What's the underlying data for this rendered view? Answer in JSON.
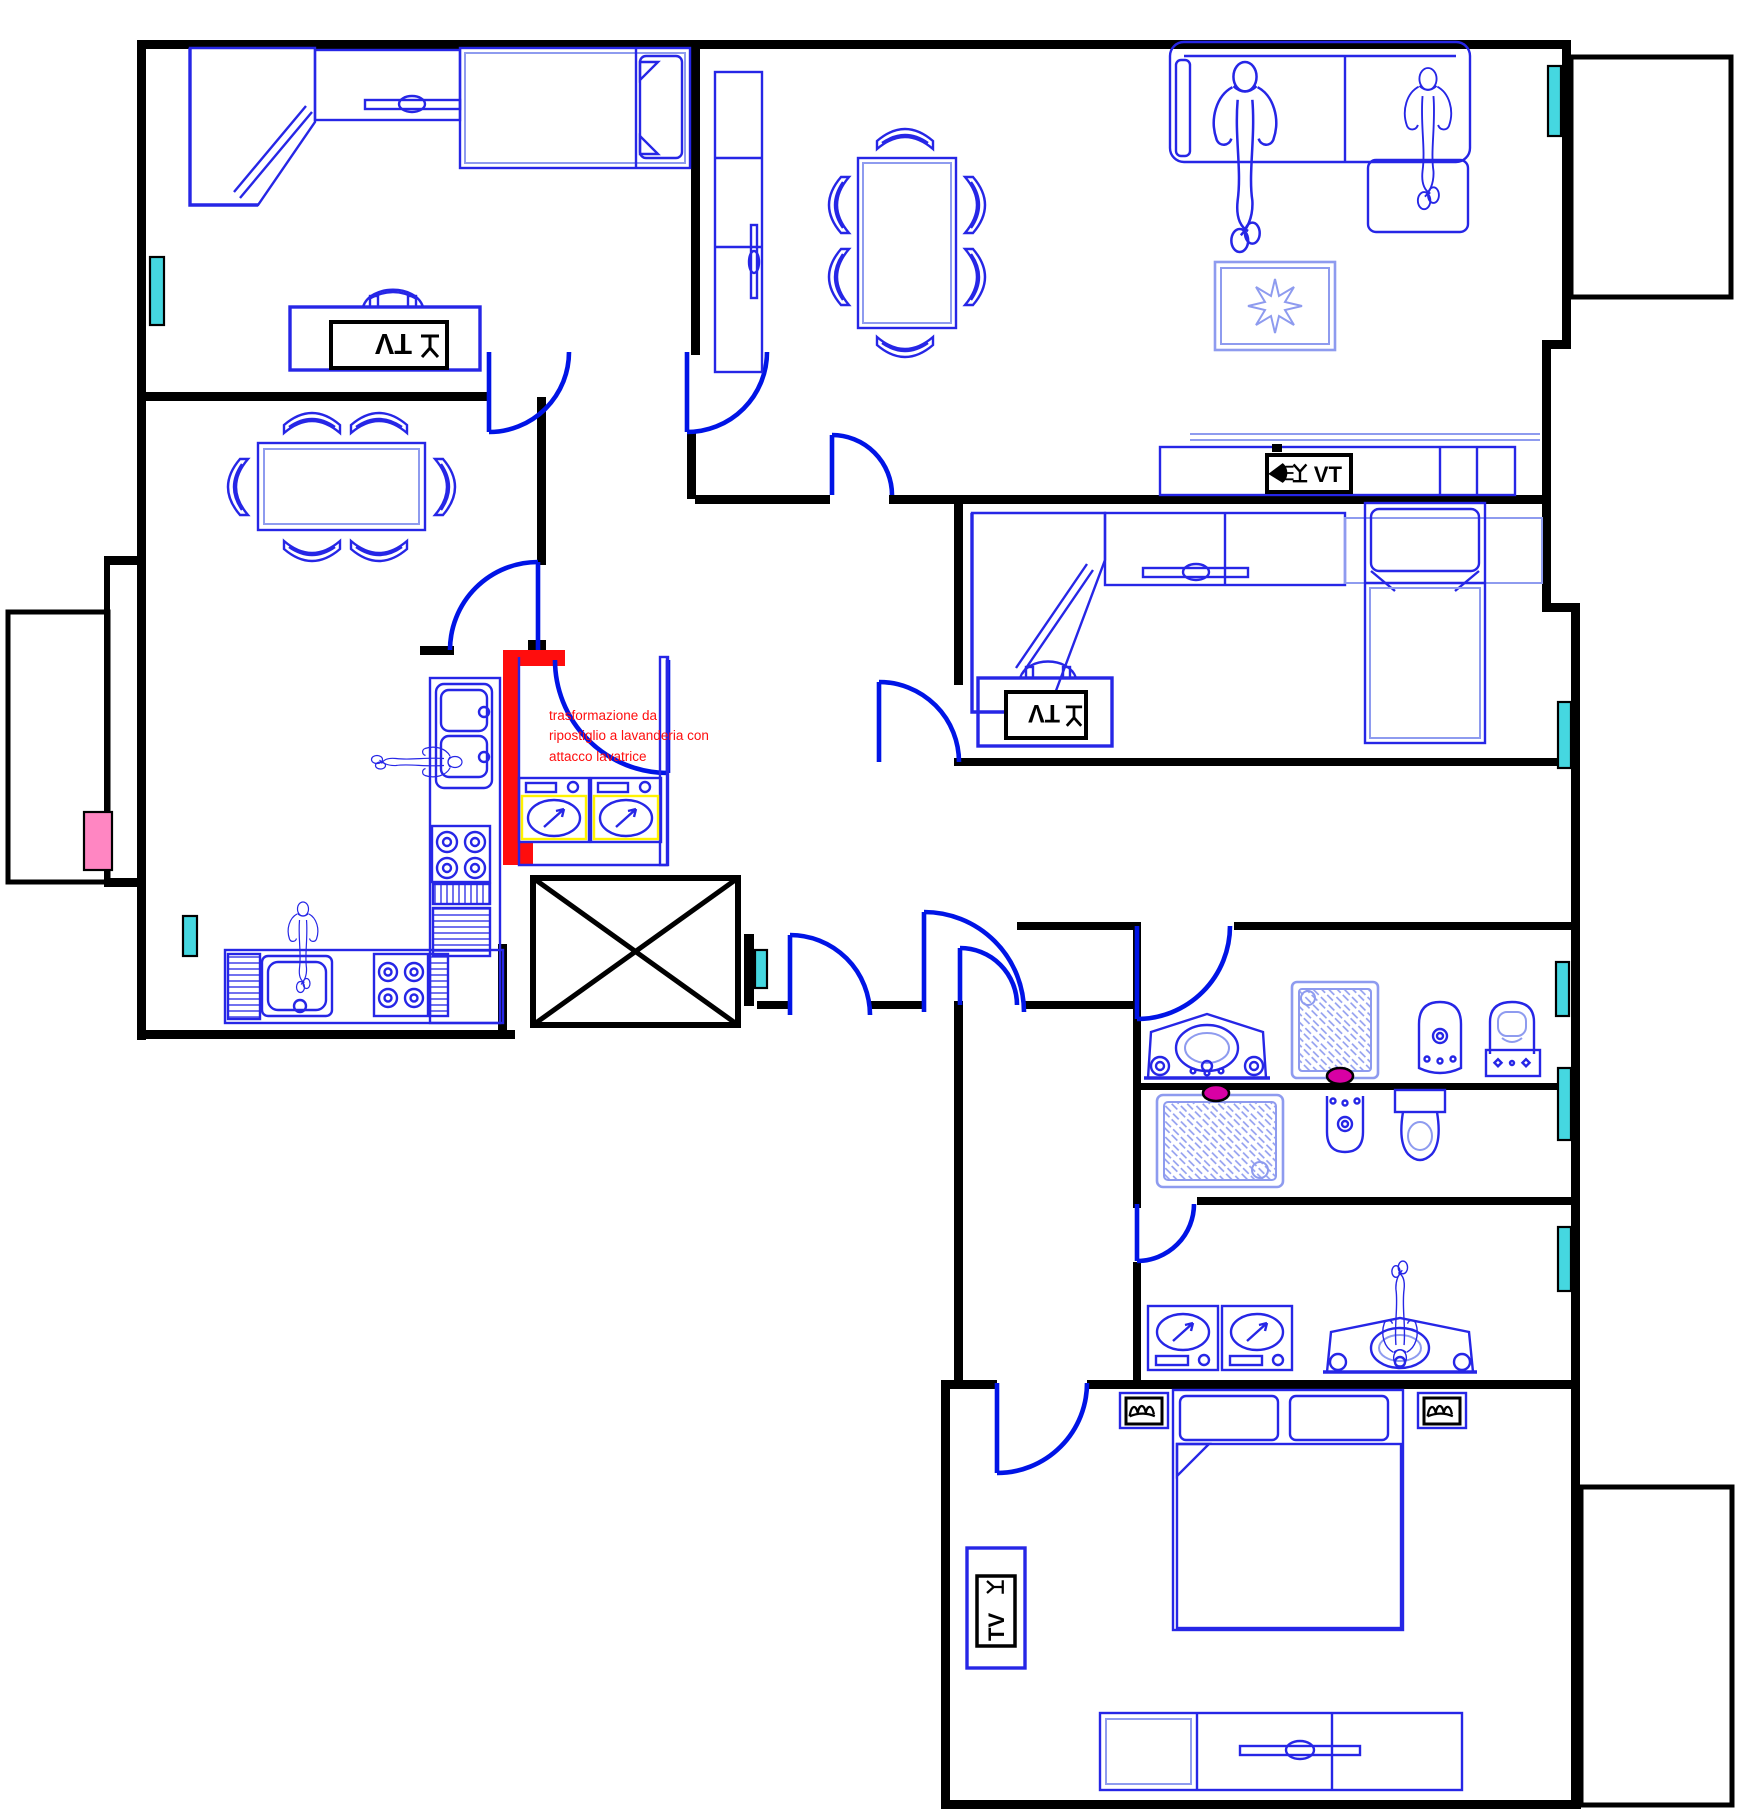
{
  "meta": {
    "type": "architectural-floor-plan",
    "style": "CAD plan view"
  },
  "annotation": {
    "text": "trasformazione da\nripostiglio a lavanderia con\nattacco lavatrice"
  },
  "labels": {
    "tv": "TV"
  },
  "colors": {
    "wall": "#000000",
    "furniture": "#2626E6",
    "furniture_light": "#8E9BEF",
    "door": "#0014E6",
    "radiator": "#45D7E0",
    "alert": "#FF0D0D",
    "magenta": "#D800A4",
    "pink": "#FF86C2",
    "yellow": "#FFF200"
  },
  "icons": {
    "tv_antenna": "inverted-Y mast on base bar",
    "satellite_dish": "filled dish wedge with signal lines",
    "nightstand_lamp": "triple-hump squiggle in black box",
    "elevator_shaft": "rectangle crossed with X",
    "washing_machine": "square with porthole circle and arrow",
    "shower_tray": "square with diagonal hatch",
    "person": "top-view human figure outline"
  }
}
